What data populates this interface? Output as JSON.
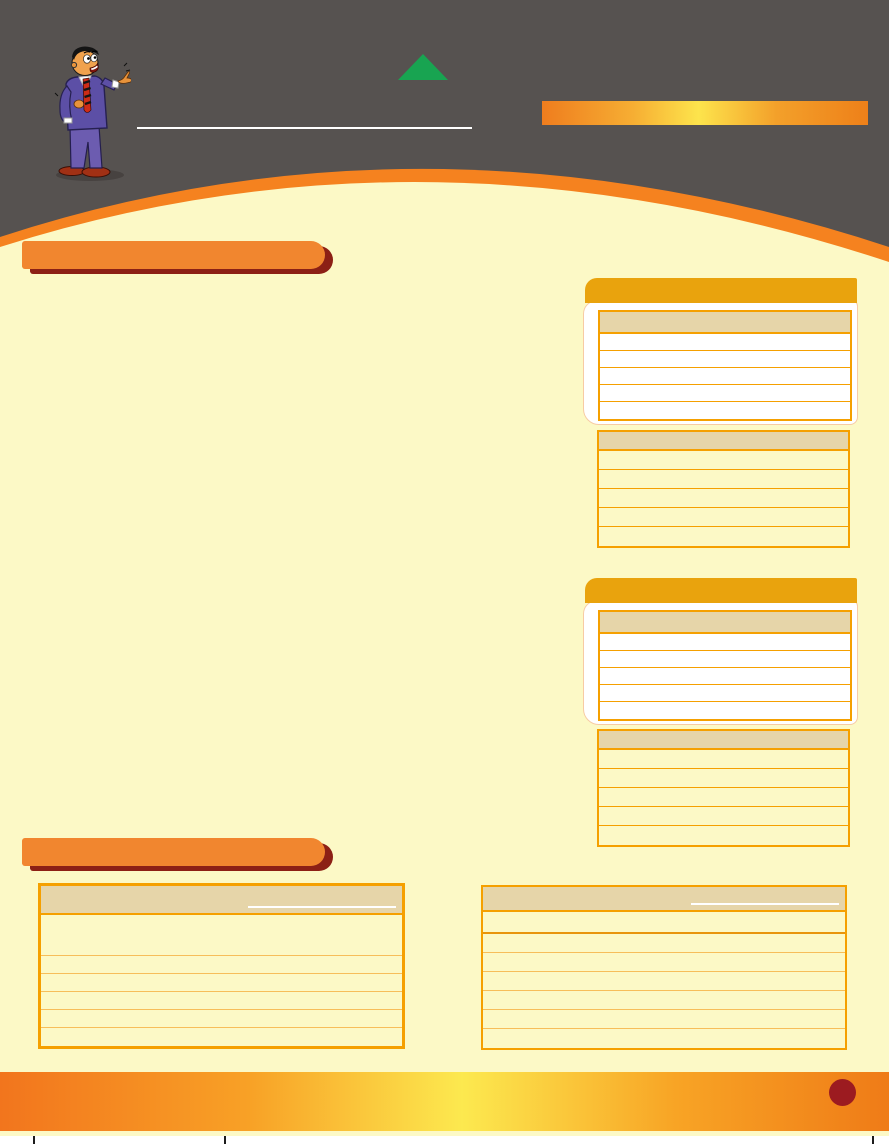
{
  "colors": {
    "page_bg": "#FCF9C6",
    "header_bg": "#565250",
    "stripe_orange": "#F5821F",
    "bar_orange": "#F1862F",
    "bar_shadow": "#8C2015",
    "cap_amber": "#E9A30D",
    "tbl_border": "#F5A000",
    "tbl_border_light": "#F7BE5A",
    "tbl_border_strong": "#E8950C",
    "tbl_header": "#E6D5A9",
    "card_edge": "#F7CBA4",
    "row_white": "#FFFFFF",
    "banner_o1": "#EF7D1E",
    "banner_y": "#FDE44C",
    "banner_o2": "#EE8019",
    "footer_o1": "#F2751D",
    "footer_y": "#FCE94F",
    "footer_o2": "#EF7B17",
    "circle_maroon": "#9C1B20",
    "green": "#18A451",
    "white": "#FFFFFF",
    "crop": "#1C1C1C"
  },
  "header": {
    "illustration_icon": "pointing-man-cartoon",
    "triangle_icon": "green-triangle",
    "banner_text": ""
  },
  "right_column": {
    "panels": [
      {
        "card_table": {
          "header": "",
          "rows": [
            "",
            "",
            "",
            "",
            ""
          ]
        },
        "flat_table": {
          "header": "",
          "rows": [
            "",
            "",
            "",
            "",
            ""
          ]
        }
      },
      {
        "card_table": {
          "header": "",
          "rows": [
            "",
            "",
            "",
            "",
            ""
          ]
        },
        "flat_table": {
          "header": "",
          "rows": [
            "",
            "",
            "",
            "",
            ""
          ]
        }
      }
    ]
  },
  "bottom_section": {
    "left_table": {
      "header": "",
      "rows": [
        "",
        "",
        "",
        "",
        "",
        ""
      ]
    },
    "right_table": {
      "header": "",
      "rows": [
        "",
        "",
        "",
        "",
        "",
        "",
        ""
      ]
    }
  },
  "footer": {
    "page_number": ""
  }
}
